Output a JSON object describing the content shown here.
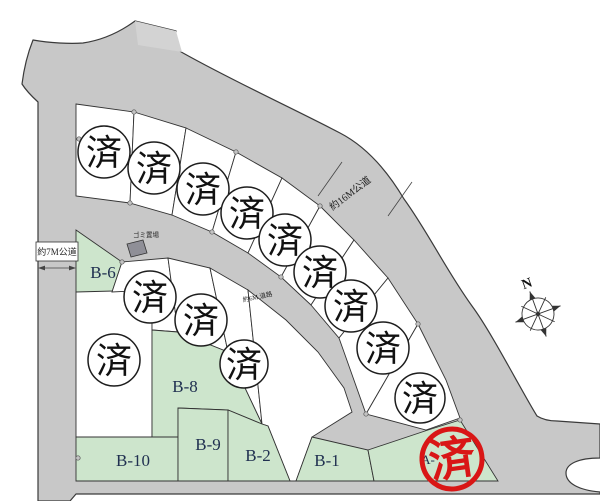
{
  "colors": {
    "road_gray": "#c8c8c8",
    "road_light_gray": "#d3d3d3",
    "available_plot_green": "#cde5cc",
    "sold_plot_white": "#ffffff",
    "stamp_red": "#d91616",
    "plot_label_navy": "#203050"
  },
  "compass": {
    "label": "N"
  },
  "roads": {
    "west": {
      "label": "約7M公道"
    },
    "main": {
      "label": "約16M公道"
    },
    "inner": {
      "label": "約6M 道路"
    }
  },
  "facilities": {
    "garbage": {
      "label": "ゴミ置場"
    }
  },
  "plots": {
    "sold_marker": "済",
    "sold_black_circle_count": 13,
    "available": [
      {
        "id": "B-6"
      },
      {
        "id": "B-8"
      },
      {
        "id": "B-10"
      },
      {
        "id": "B-9"
      },
      {
        "id": "B-2"
      },
      {
        "id": "B-1"
      }
    ]
  },
  "stamp": {
    "text": "済",
    "partial_plot_label": "A-"
  }
}
